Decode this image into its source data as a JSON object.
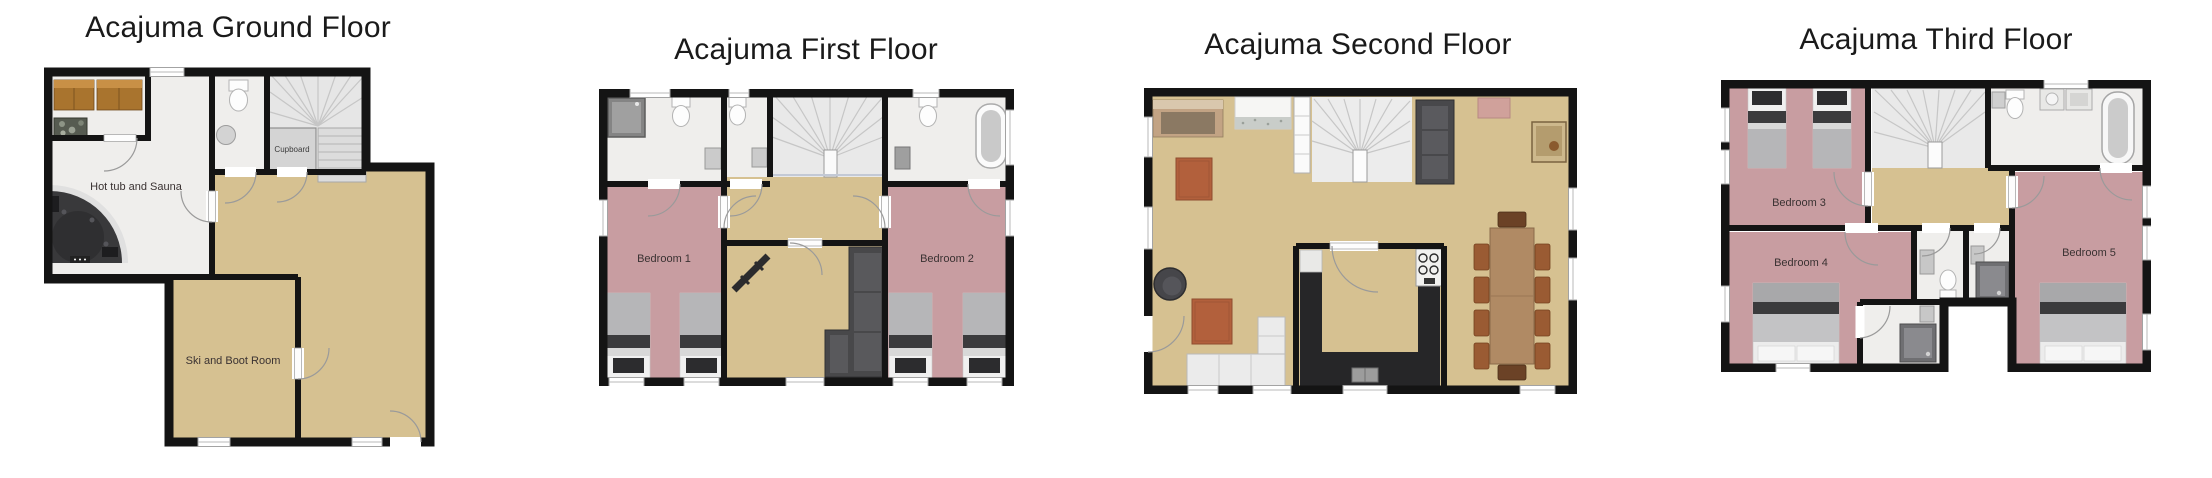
{
  "palette": {
    "wall": "#141414",
    "floor_tan": "#d6c191",
    "floor_pink": "#c89da1",
    "floor_tile": "#efeeec",
    "floor_stairs": "#e9e9e9",
    "title_text": "#1a1a1a",
    "label_text": "#3a3232",
    "rug": "#b2603c",
    "wood_bench": "#a9742e",
    "table_wood": "#b08a64",
    "chair_brown": "#9a5b33",
    "sofa_dark": "#48484b",
    "counter_dark": "#262628",
    "hot_tub": "#39393b"
  },
  "floors": [
    {
      "title": "Acajuma Ground Floor",
      "rooms": {
        "hot_tub_sauna": "Hot tub and Sauna",
        "cupboard": "Cupboard",
        "ski_boot": "Ski and Boot Room"
      }
    },
    {
      "title": "Acajuma First Floor",
      "rooms": {
        "bedroom_1": "Bedroom 1",
        "bedroom_2": "Bedroom 2"
      }
    },
    {
      "title": "Acajuma Second Floor",
      "rooms": {}
    },
    {
      "title": "Acajuma Third Floor",
      "rooms": {
        "bedroom_3": "Bedroom 3",
        "bedroom_4": "Bedroom 4",
        "bedroom_5": "Bedroom 5"
      }
    }
  ]
}
